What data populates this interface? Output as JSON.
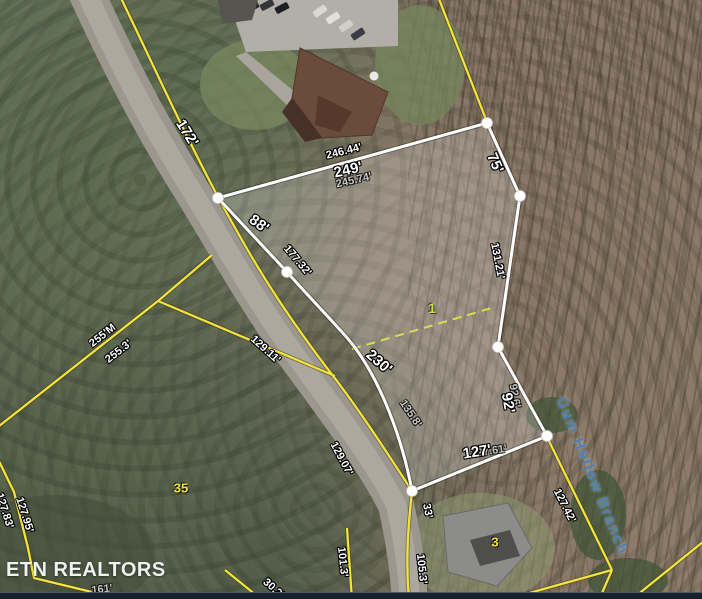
{
  "map": {
    "type": "aerial-parcel-map",
    "stream_label": "Gum Hollow Branch",
    "watermark": "ETN REALTORS",
    "highlighted_parcel_number": "1",
    "neighbor_parcel_numbers": [
      "35",
      "3"
    ],
    "colors": {
      "boundary_yellow": "#f2e33e",
      "parcel_outline_white": "#fdfdfd",
      "division_dash_green": "#d6df52",
      "stream_text_blue": "#4e80b3",
      "watermark_white": "#f0f2ef",
      "parcel_number_yellow": "#f5e43a",
      "lot_number_green": "#cfe04a",
      "bottom_bar_navy": "#16222e"
    },
    "labels": [
      {
        "text": "172'",
        "x": 187,
        "y": 133,
        "rot": 58,
        "cls": "dim-big"
      },
      {
        "text": "246.44'",
        "x": 344,
        "y": 152,
        "rot": -14,
        "cls": "dim"
      },
      {
        "text": "249'",
        "x": 348,
        "y": 170,
        "rot": -13,
        "cls": "dim-big"
      },
      {
        "text": "245.74'",
        "x": 354,
        "y": 181,
        "rot": -13,
        "cls": "dim-gray"
      },
      {
        "text": "75'",
        "x": 495,
        "y": 163,
        "rot": 66,
        "cls": "dim-big"
      },
      {
        "text": "88'",
        "x": 259,
        "y": 224,
        "rot": 36,
        "cls": "dim-big"
      },
      {
        "text": "177.32'",
        "x": 297,
        "y": 261,
        "rot": 50,
        "cls": "dim"
      },
      {
        "text": "131.21'",
        "x": 497,
        "y": 261,
        "rot": 79,
        "cls": "dim"
      },
      {
        "text": "1",
        "x": 432,
        "y": 308,
        "rot": 0,
        "cls": "num-green"
      },
      {
        "text": "230'",
        "x": 379,
        "y": 362,
        "rot": 41,
        "cls": "dim-big"
      },
      {
        "text": "135.8'",
        "x": 410,
        "y": 414,
        "rot": 56,
        "cls": "dim-gray"
      },
      {
        "text": "92.6'",
        "x": 514,
        "y": 396,
        "rot": 80,
        "cls": "dim-gray"
      },
      {
        "text": "92'",
        "x": 508,
        "y": 403,
        "rot": 80,
        "cls": "dim-big"
      },
      {
        "text": "127.61'",
        "x": 489,
        "y": 452,
        "rot": -9,
        "cls": "dim-gray"
      },
      {
        "text": "127'",
        "x": 477,
        "y": 452,
        "rot": -9,
        "cls": "dim-big"
      },
      {
        "text": "129.07'",
        "x": 341,
        "y": 459,
        "rot": 62,
        "cls": "dim"
      },
      {
        "text": "33'",
        "x": 427,
        "y": 511,
        "rot": 78,
        "cls": "dim"
      },
      {
        "text": "101.3'",
        "x": 342,
        "y": 562,
        "rot": 84,
        "cls": "dim"
      },
      {
        "text": "105.3'",
        "x": 421,
        "y": 569,
        "rot": 84,
        "cls": "dim"
      },
      {
        "text": "30.2'",
        "x": 273,
        "y": 589,
        "rot": 42,
        "cls": "dim"
      },
      {
        "text": "255'M",
        "x": 103,
        "y": 336,
        "rot": -38,
        "cls": "dim"
      },
      {
        "text": "255.3'",
        "x": 119,
        "y": 352,
        "rot": -38,
        "cls": "dim"
      },
      {
        "text": "129.11'",
        "x": 265,
        "y": 350,
        "rot": 42,
        "cls": "dim"
      },
      {
        "text": "127.95'",
        "x": 24,
        "y": 515,
        "rot": 72,
        "cls": "dim"
      },
      {
        "text": "127.83'",
        "x": 4,
        "y": 511,
        "rot": 72,
        "cls": "dim"
      },
      {
        "text": "127.42'",
        "x": 564,
        "y": 506,
        "rot": 63,
        "cls": "dim"
      },
      {
        "text": "161'",
        "x": 102,
        "y": 590,
        "rot": -6,
        "cls": "dim-gray"
      },
      {
        "text": "35",
        "x": 181,
        "y": 488,
        "rot": 0,
        "cls": "num-yellow"
      },
      {
        "text": "3",
        "x": 495,
        "y": 542,
        "rot": 0,
        "cls": "num-yellow"
      }
    ]
  }
}
